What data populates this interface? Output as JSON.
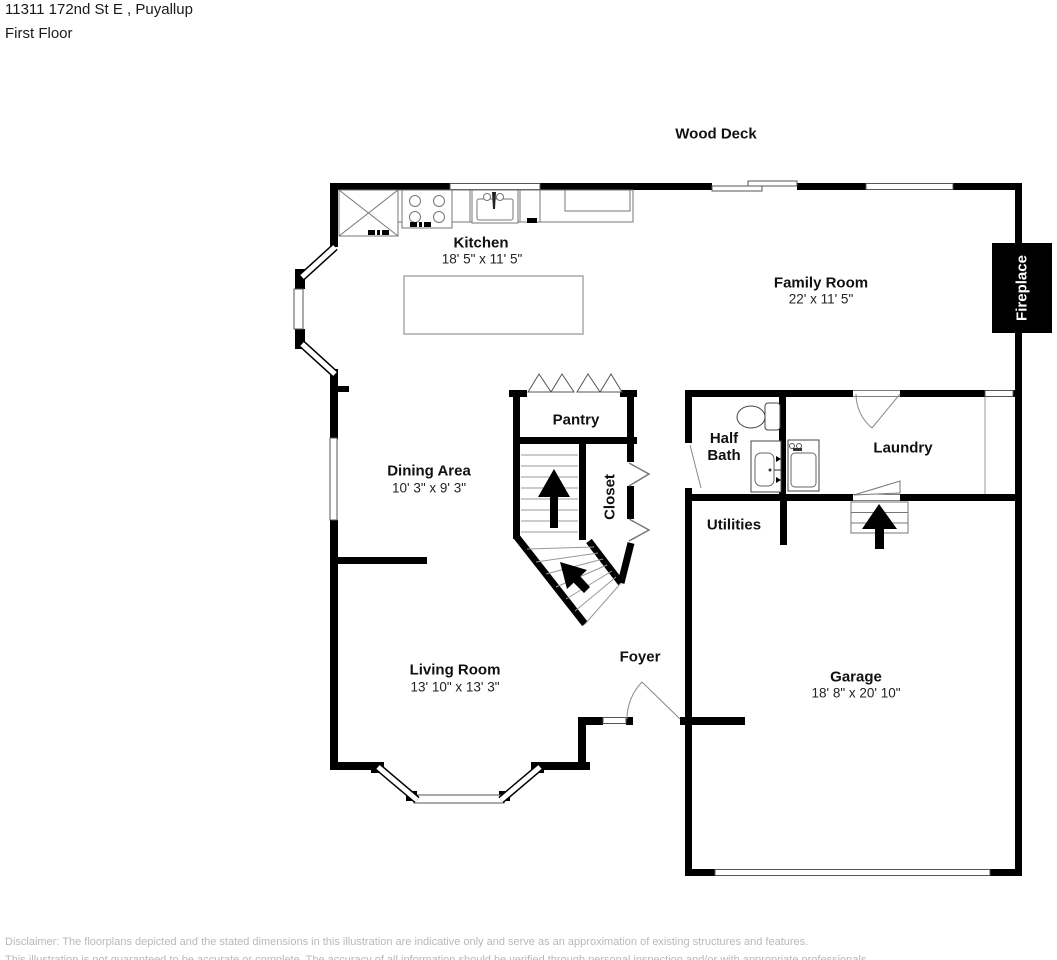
{
  "header": {
    "address": "11311 172nd St E , Puyallup",
    "floor": "First Floor"
  },
  "deck": {
    "label": "Wood Deck"
  },
  "rooms": {
    "kitchen": {
      "name": "Kitchen",
      "dims": "18' 5\" x 11' 5\""
    },
    "family_room": {
      "name": "Family Room",
      "dims": "22' x 11' 5\""
    },
    "dining_area": {
      "name": "Dining Area",
      "dims": "10' 3\" x 9' 3\""
    },
    "living_room": {
      "name": "Living Room",
      "dims": "13' 10\" x 13' 3\""
    },
    "garage": {
      "name": "Garage",
      "dims": "18' 8\" x 20' 10\""
    },
    "pantry": {
      "name": "Pantry"
    },
    "half_bath": {
      "name": "Half Bath"
    },
    "laundry": {
      "name": "Laundry"
    },
    "closet": {
      "name": "Closet"
    },
    "utilities": {
      "name": "Utilities"
    },
    "foyer": {
      "name": "Foyer"
    },
    "fireplace": {
      "name": "Fireplace"
    }
  },
  "disclaimer": {
    "line1": "Disclaimer: The floorplans depicted and the stated dimensions in this illustration are indicative only and serve as an approximation of existing structures and features.",
    "line2": "This illustration is not guaranteed to be accurate or complete. The accuracy of all information should be verified through personal inspection and/or with appropriate professionals."
  },
  "colors": {
    "wall": "#000000",
    "fixture_line": "#666666",
    "text": "#111111",
    "fireplace_bg": "#000000",
    "fireplace_text": "#ffffff",
    "disclaimer_text": "#b9b9b9"
  }
}
